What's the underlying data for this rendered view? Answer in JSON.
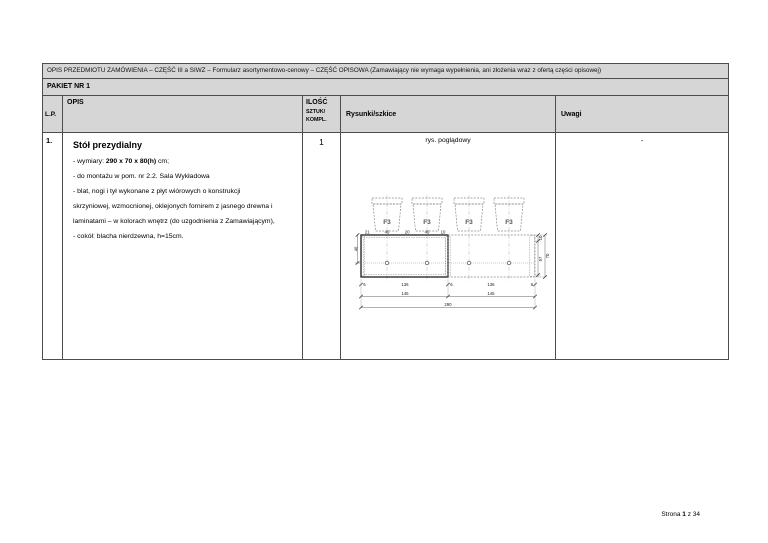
{
  "page": {
    "header_bar": "OPIS PRZEDMIOTU ZAMÓWIENIA – CZĘŚĆ III a SIWZ – Formularz asortymentowo-cenowy – CZĘŚĆ OPISOWA (Zamawiający nie wymaga wypełnienia, ani złożenia wraz z ofertą części opisowej)",
    "packet_title": "PAKIET NR 1",
    "footer": {
      "prefix": "Strona ",
      "page_number": "1",
      "suffix": " z 34"
    }
  },
  "table": {
    "headers": {
      "lp": "L.P.",
      "opis": "OPIS",
      "ilosc_line1": "ILOŚĆ",
      "ilosc_line2": "SZTUK/",
      "ilosc_line3": "KOMPL.",
      "rysunki": "Rysunki/szkice",
      "uwagi": "Uwagi"
    },
    "row": {
      "lp": "1.",
      "title": "Stół prezydialny",
      "desc_line1_prefix": "- wymiary: ",
      "desc_line1_bold": "290 x 70 x 80(h)",
      "desc_line1_suffix": " cm;",
      "desc_lines": [
        "- do montażu w pom. nr 2.2. Sala Wykładowa",
        "- blat, nogi i tył wykonane z płyt wiórowych o konstrukcji",
        "skrzyniowej, wzmocnionej, oklejonych fornirem z jasnego drewna  i",
        "laminatami – w kolorach wnętrz (do uzgodnienia z Zamawiającym),",
        "- cokół: blacha nierdzewna, h=15cm."
      ],
      "ilosc": "1",
      "sketch_caption": "rys. poglądowy",
      "uwagi": "-"
    }
  },
  "drawing": {
    "chair_label": "F3",
    "top_dims": [
      "21",
      "46",
      "20",
      "46",
      "10"
    ],
    "left_dim": "46",
    "right_dims": [
      "10",
      "57",
      "70"
    ],
    "bottom_row1": [
      "6",
      "136",
      "6",
      "136",
      "6"
    ],
    "bottom_row2": [
      "145",
      "145"
    ],
    "bottom_total": "290"
  }
}
